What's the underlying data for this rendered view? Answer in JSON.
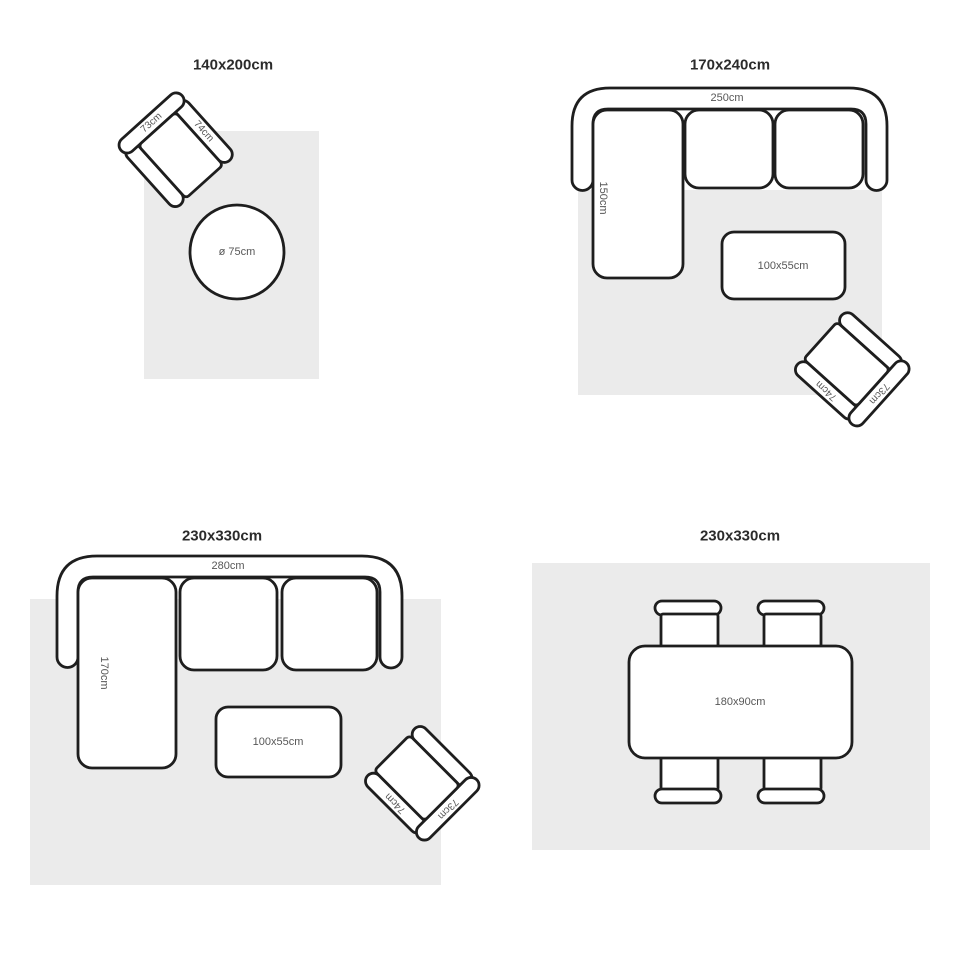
{
  "colors": {
    "rug": "#ebebeb",
    "outline": "#1e1e1e",
    "label": "#575757",
    "title": "#2b2b2b",
    "furniture_fill": "#ffffff"
  },
  "layouts": {
    "tl": {
      "title": "140x200cm",
      "armchair_back": "73cm",
      "armchair_arm": "74cm",
      "round_table_label": "ø 75cm"
    },
    "tr": {
      "title": "170x240cm",
      "sofa_width": "250cm",
      "sofa_depth": "150cm",
      "coffee_table_label": "100x55cm",
      "armchair_back": "73cm",
      "armchair_arm": "74cm"
    },
    "bl": {
      "title": "230x330cm",
      "sofa_width": "280cm",
      "sofa_depth": "170cm",
      "coffee_table_label": "100x55cm",
      "armchair_back": "73cm",
      "armchair_arm": "74cm"
    },
    "br": {
      "title": "230x330cm",
      "dining_table_label": "180x90cm"
    }
  }
}
